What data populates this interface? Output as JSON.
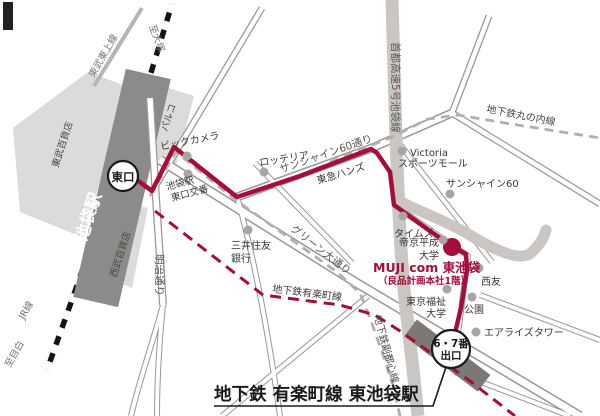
{
  "map_title": "MUJI com 東池袋 アクセスマップ",
  "colors": {
    "route_red": "#a60d3c",
    "building_gray": "#dcdbd9",
    "jr_station_gray": "#8d8b89",
    "subway_station_gray": "#7b7876",
    "road_casing": "#9a9795",
    "expressway_gray": "#c9c6c3",
    "subway_dash_gray": "#b2afac",
    "dot_gray": "#a8a5a2",
    "text_dark": "#3a3634"
  },
  "station": {
    "name": "池袋駅",
    "east_exit": "東口",
    "exit67_line1": "6・7番",
    "exit67_line2": "出口"
  },
  "railways": {
    "jr_line": "JR線",
    "tobu_tojo_line": "東武東上線",
    "to_otsuka": "至大塚",
    "to_mejiro": "至目白"
  },
  "subway_lines": {
    "marunouchi": "地下鉄丸の内線",
    "yurakucho": "地下鉄有楽町線",
    "fukutoshin": "地下鉄副都心線"
  },
  "streets": {
    "meiji_dori": "明治通り",
    "sunshine60_dori": "サンシャイン60通り",
    "green_odori": "グリーン大通り",
    "shuto_expressway": "首都高速5号池袋線"
  },
  "buildings": {
    "tobu_dept": "東武百貨店",
    "seibu_dept": "西武百貨店",
    "parco": "パルコ"
  },
  "pois": {
    "bic_camera": "ビックカメラ",
    "lotteria": "ロッテリア",
    "tokyu_hands": "東急ハンズ",
    "koban_line1": "池袋駅",
    "koban_line2": "東口交番",
    "smbc_line1": "三井住友",
    "smbc_line2": "銀行",
    "victoria_line1": "Victoria",
    "victoria_line2": "スポーツモール",
    "sunshine60": "サンシャイン60",
    "times": "タイムズ",
    "teikyo_line1": "帝京平成",
    "teikyo_line2": "大学",
    "seiyu": "西友",
    "park": "公園",
    "fukushi_line1": "東京福祉",
    "fukushi_line2": "大学",
    "airrise_tower": "エアライズタワー"
  },
  "destination": {
    "title": "MUJI com 東池袋",
    "subtitle": "（良品計画本社1階）"
  },
  "caption": "地下鉄 有楽町線 東池袋駅"
}
